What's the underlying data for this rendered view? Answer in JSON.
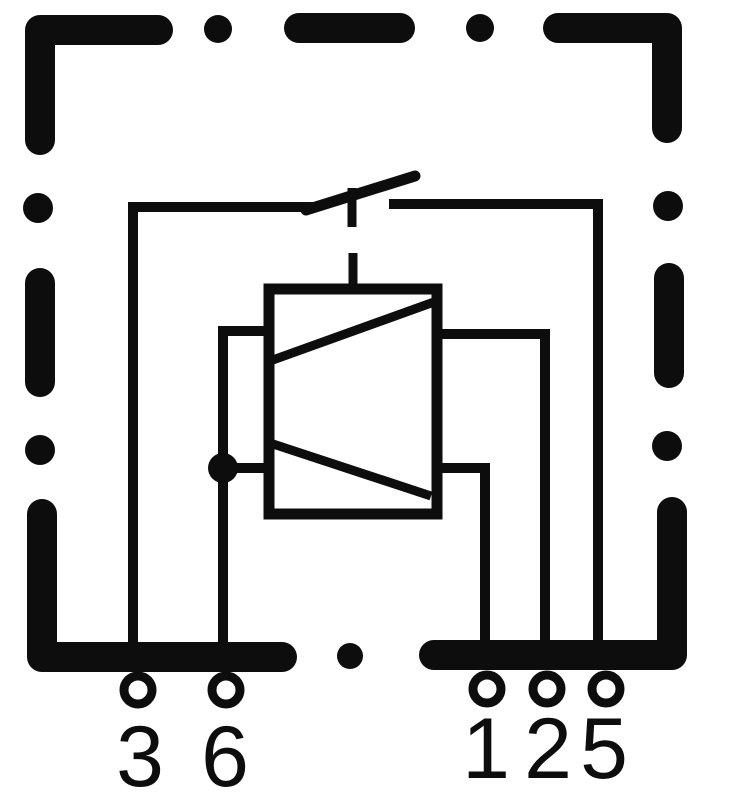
{
  "diagram": {
    "kind": "relay-internal-wiring-schematic",
    "colors": {
      "ink": "#0d0d0d",
      "background": "#ffffff"
    },
    "pins": {
      "left": [
        {
          "label": "3"
        },
        {
          "label": "6"
        }
      ],
      "right": [
        {
          "label": "1"
        },
        {
          "label": "2"
        },
        {
          "label": "5"
        }
      ]
    },
    "components": [
      {
        "name": "dashed-housing-outline",
        "icon": "dashed-frame-icon"
      },
      {
        "name": "normally-open-switch-contact",
        "icon": "switch-contact-icon"
      },
      {
        "name": "relay-coil",
        "icon": "coil-box-icon"
      },
      {
        "name": "mechanical-actuator-link",
        "icon": "dashed-link-icon"
      },
      {
        "name": "wire-junction",
        "icon": "junction-dot-icon"
      },
      {
        "name": "terminals",
        "icon": "terminal-ring-icon"
      }
    ]
  }
}
